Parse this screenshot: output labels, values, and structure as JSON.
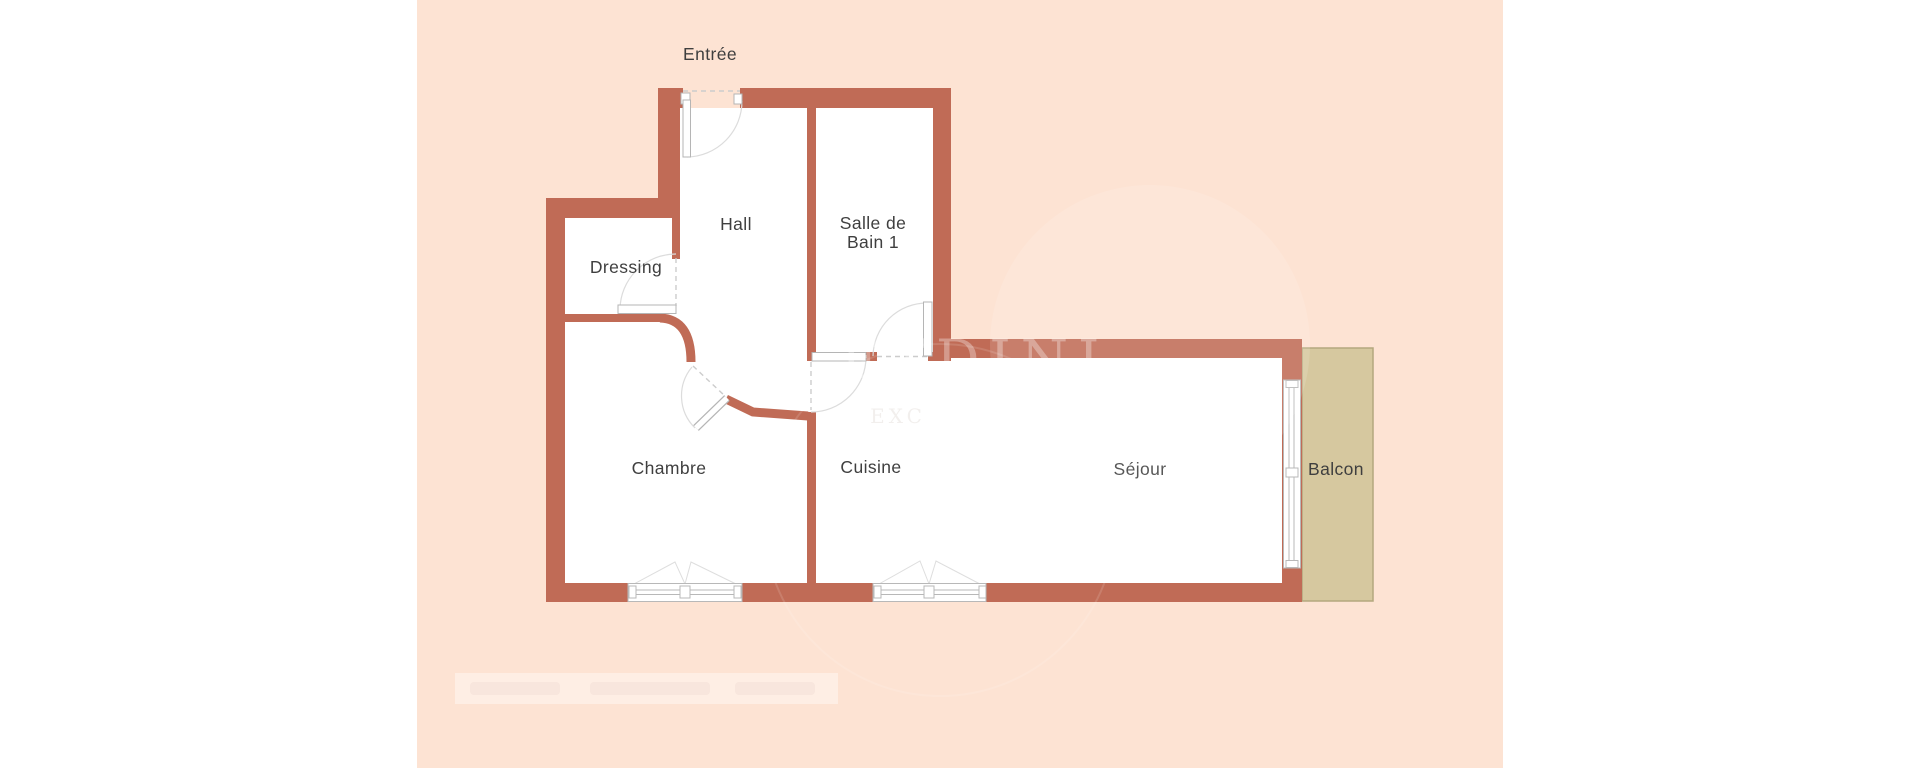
{
  "colors": {
    "page_bg": "#ffffff",
    "floor_bg": "#fde3d3",
    "wall": "#c06b56",
    "room_fill": "#ffffff",
    "balcony_fill": "#d6c89f",
    "balcony_border": "#b3a87e",
    "label": "#3f3f3f",
    "glyph": "#cccccc",
    "arc": "#dcdcdc",
    "winline": "#b8b8b8",
    "leafline": "#b5b5b5",
    "tri": "#dedede"
  },
  "floor_plan": {
    "entrance_label": "Entrée",
    "rooms": [
      {
        "name": "hall",
        "label": "Hall"
      },
      {
        "name": "salle-de-bain-1",
        "label_line1": "Salle de",
        "label_line2": "Bain 1"
      },
      {
        "name": "dressing",
        "label": "Dressing"
      },
      {
        "name": "chambre",
        "label": "Chambre"
      },
      {
        "name": "cuisine",
        "label": "Cuisine"
      },
      {
        "name": "sejour",
        "label": "Séjour"
      },
      {
        "name": "balcon",
        "label": "Balcon"
      }
    ],
    "watermark": {
      "text_large": "ETDINI",
      "text_small": "EXC"
    }
  }
}
